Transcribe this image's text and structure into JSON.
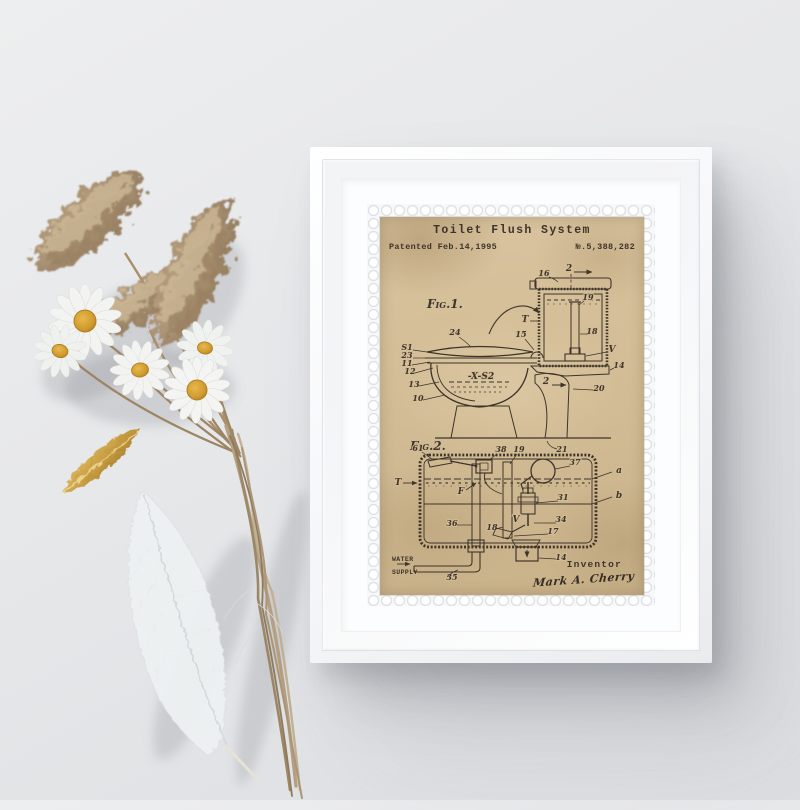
{
  "colors": {
    "wall": "#e7e8ea",
    "frame": "#fbfcfd",
    "paper": "#d3bd97",
    "ink": "#3e342a",
    "daisy_center": "#d9a637",
    "pampas": "#ab9374",
    "gold_feather": "#c49a3f"
  },
  "print": {
    "title": "Toilet Flush System",
    "patented": "Patented Feb.14,1995",
    "patent_number": "№.5,388,282",
    "inventor_label": "Inventor",
    "inventor_signature": "Mark A. Cherry",
    "fig1": {
      "caption": "Fig.1.",
      "labels": {
        "sec_top": "2",
        "n16": "16",
        "n19": "19",
        "t": "T",
        "n18": "18",
        "v": "V",
        "n15": "15",
        "n14": "14",
        "n24": "24",
        "s1": "S1",
        "n23": "23",
        "n11": "11",
        "n12": "12",
        "n13": "13",
        "n10": "10",
        "xs2": "-X-S2",
        "sec_side": "2",
        "n20": "20",
        "n21": "21"
      }
    },
    "fig2": {
      "caption": "Fig.2.",
      "labels": {
        "n61": "61",
        "n38": "38",
        "n19": "19",
        "n37": "37",
        "a": "a",
        "b": "b",
        "t": "T",
        "f": "F",
        "n31": "31",
        "n36": "36",
        "n18": "18",
        "v": "V",
        "n34": "34",
        "n17": "17",
        "n14": "14",
        "n35": "35",
        "water": "WATER",
        "supply": "SUPPLY"
      }
    }
  }
}
